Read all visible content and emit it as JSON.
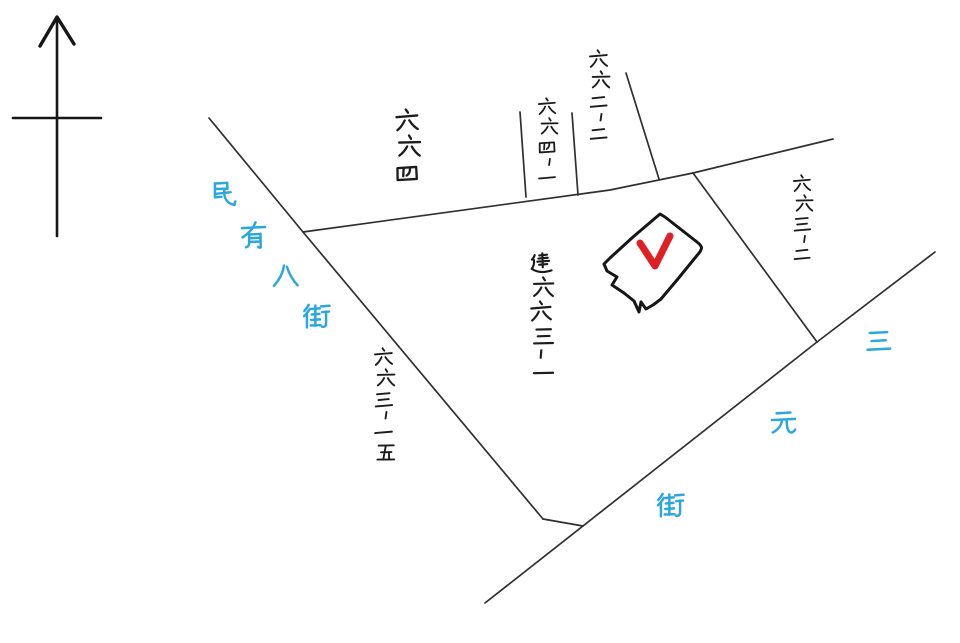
{
  "canvas": {
    "width": 960,
    "height": 643,
    "background": "#ffffff"
  },
  "compass": {
    "name": "north-arrow",
    "direction": "N"
  },
  "streets": {
    "left": {
      "name": "民有八街",
      "color": "#2aa7dd"
    },
    "right": {
      "name": "三元街",
      "color": "#2aa7dd"
    }
  },
  "lots": {
    "lot_664": {
      "label": "六六四"
    },
    "lot_664_1": {
      "label": "六六四-一"
    },
    "lot_662_2": {
      "label": "六六二-二"
    },
    "lot_663_2": {
      "label": "六六三-二"
    },
    "lot_663_15": {
      "label": "六六三-一五"
    },
    "building": {
      "label": "建六六三-一"
    }
  },
  "marker": {
    "shape": "checkmark",
    "color": "#e01f24",
    "location": "inside building 663-1"
  },
  "colors": {
    "ink": "#1c1c1c",
    "line": "#2f2f2f",
    "street_label_blue": "#2aa7dd",
    "check_red": "#e01f24"
  }
}
